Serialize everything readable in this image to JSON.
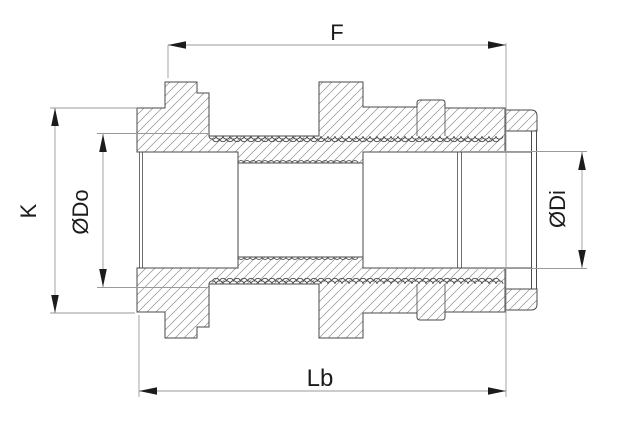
{
  "drawing": {
    "kind": "threaded coupling cross-section",
    "labels": {
      "thread_length_top": "F",
      "hex_height_left": "K",
      "outer_diameter": "ØDo",
      "inner_diameter": "ØDi",
      "body_length_bottom": "Lb"
    },
    "colors": {
      "background": "#ffffff",
      "outline": "#4a4a4a",
      "hatch": "#8f8f8f",
      "dimension_line": "#9a9a9a",
      "text": "#1c1c1c"
    }
  }
}
